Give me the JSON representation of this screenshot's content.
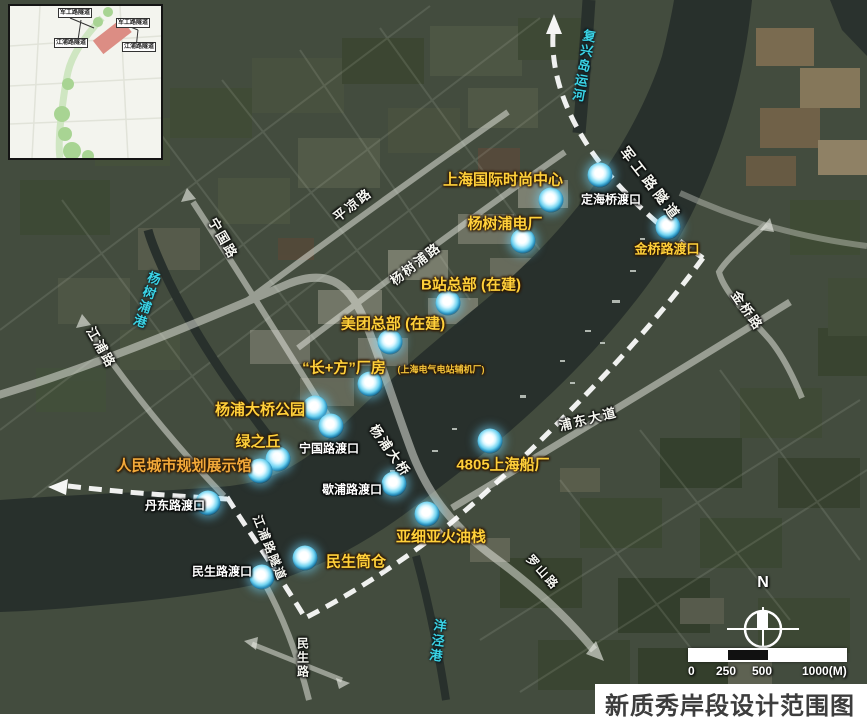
{
  "title": "新质秀岸段设计范围图",
  "inset": {
    "labels": {
      "tl": "军工路隧道",
      "tr": "军工路隧道",
      "bl": "江浦路隧道",
      "br": "江浦路隧道"
    }
  },
  "landmarks": {
    "fashion_center": "上海国际时尚中心",
    "power_plant": "杨树浦电厂",
    "bilibili_hq": "B站总部 (在建)",
    "meituan_hq": "美团总部 (在建)",
    "changfang_plant": "“长+方”厂房",
    "changfang_plant_note": "(上海电气电站辅机厂)",
    "bridge_park": "杨浦大桥公园",
    "green_hill": "绿之丘",
    "planning_hall": "人民城市规划展示馆",
    "shipyard_4805": "4805上海船厂",
    "asia_oil_depot": "亚细亚火油栈",
    "minsheng_silo": "民生筒仓",
    "jinqiao_ferry": "金桥路渡口"
  },
  "ferries": {
    "dinghai": "定海桥渡口",
    "ningguo": "宁国路渡口",
    "xiepu": "歇浦路渡口",
    "dandong": "丹东路渡口",
    "minsheng": "民生路渡口"
  },
  "roads": {
    "jungong_tunnel": "军工路隧道",
    "pingliang_rd": "平凉路",
    "yangshupu_rd": "杨树浦路",
    "ningguo_rd": "宁国路",
    "jiangpu_rd": "江浦路",
    "yangpu_bridge": "杨浦大桥",
    "pudong_ave": "浦东大道",
    "jinqiao_rd": "金桥路",
    "jiangpu_tunnel": "江浦路隧道",
    "minsheng_rd": "民生路",
    "luoshan_rd": "罗山路"
  },
  "waterways": {
    "fuxing_canal": "复兴岛运河",
    "yangshupu_port": "杨树浦港",
    "yangjing_port": "洋泾港"
  },
  "compass": {
    "north": "N"
  },
  "scalebar": {
    "ticks": [
      "0",
      "250",
      "500",
      "1000(M)"
    ]
  },
  "colors": {
    "landmark_yellow": "#ffd03a",
    "landmark_orange": "#f2a93a",
    "ferry_white": "#ffffff",
    "water_cyan": "#3bd4e6",
    "boundary_white": "#ffffff",
    "inset_highlight_red": "#dc8d84"
  }
}
